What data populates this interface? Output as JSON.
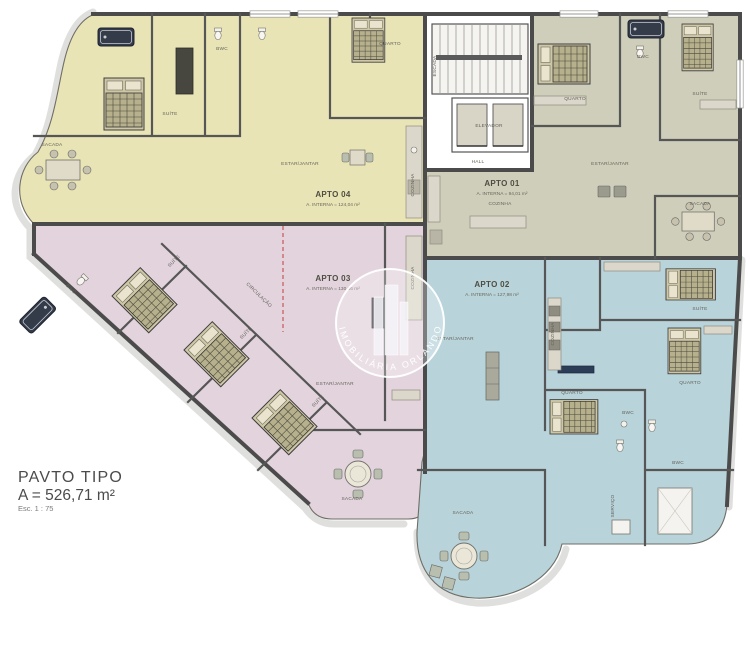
{
  "plan": {
    "title": "PAVTO TIPO",
    "area_total": "A = 526,71 m²",
    "scale": "Esc. 1 : 75"
  },
  "watermark": {
    "text": "IMOBILIÁRIA ORLANDO"
  },
  "apartments": [
    {
      "label": "APTO 04",
      "area": "A. INTERNA = 124,04 m²",
      "color": "#e9e4b6"
    },
    {
      "label": "APTO 01",
      "area": "A. INTERNA = 94,01 m²",
      "color": "#cfceba"
    },
    {
      "label": "APTO 03",
      "area": "A. INTERNA = 130,66 m²",
      "color": "#e3d3dd"
    },
    {
      "label": "APTO 02",
      "area": "A. INTERNA = 127,98 m²",
      "color": "#b8d3da"
    }
  ],
  "core": {
    "escada": "ESCADA",
    "elevador": "ELEVADOR",
    "hall": "HALL"
  },
  "rooms": {
    "suite": "SUÍTE",
    "quarto": "QUARTO",
    "bwc": "BWC",
    "cozinha": "COZINHA",
    "estar_jantar": "ESTAR/JANTAR",
    "sacada": "SACADA",
    "circulacao": "CIRCULAÇÃO",
    "servico": "SERVIÇO"
  }
}
